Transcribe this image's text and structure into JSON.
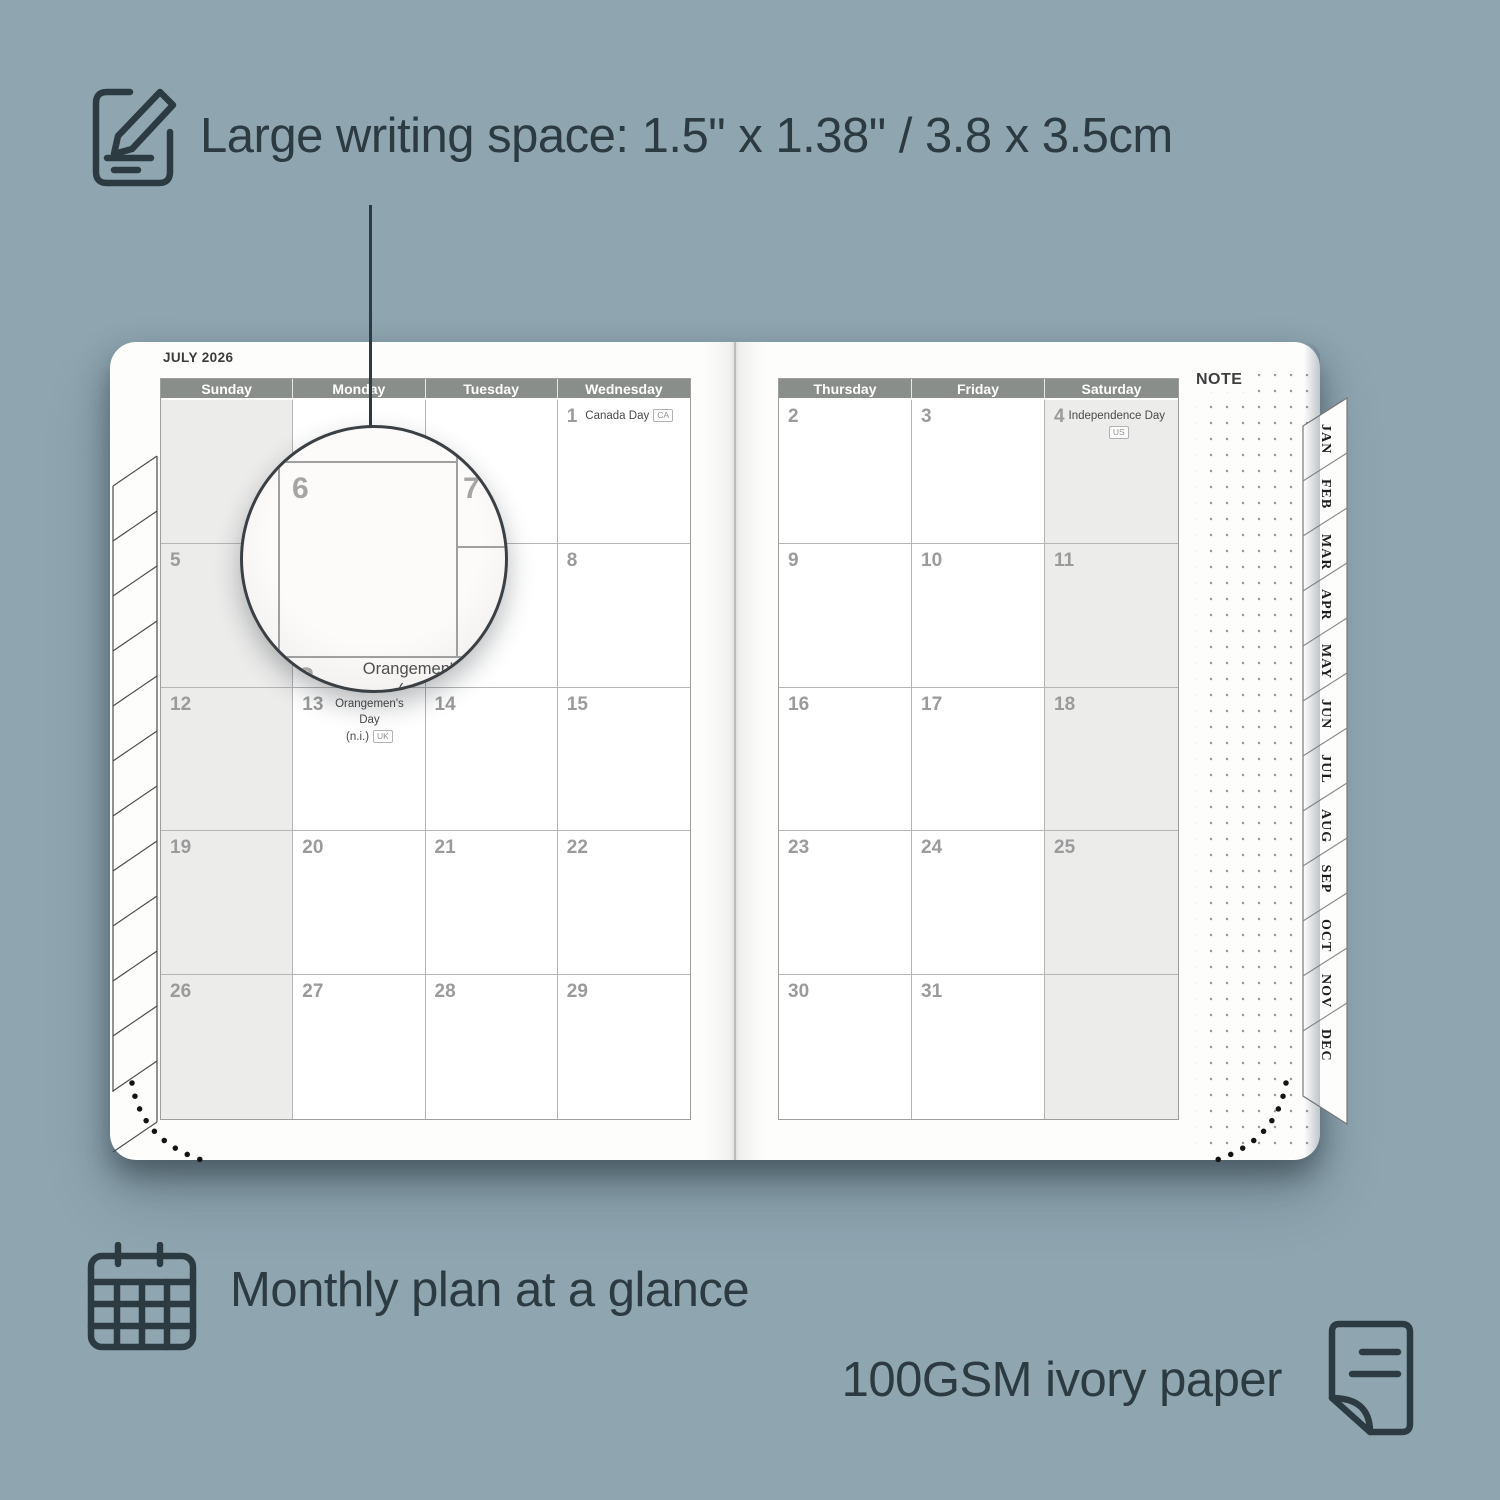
{
  "colors": {
    "background": "#8fa6b1",
    "ink": "#2c3a42",
    "page": "#fdfdfc",
    "day_header_bar": "#8a8e8a",
    "shaded_cell": "#ececeb",
    "date_number": "#9b9b9b"
  },
  "callouts": {
    "writing_space": "Large writing space: 1.5\" x 1.38\" / 3.8 x 3.5cm",
    "monthly_plan": "Monthly plan at a glance",
    "paper": "100GSM ivory paper"
  },
  "planner": {
    "month_title": "JULY 2026",
    "note_label": "NOTE",
    "month_tabs": [
      "JAN",
      "FEB",
      "MAR",
      "APR",
      "MAY",
      "JUN",
      "JUL",
      "AUG",
      "SEP",
      "OCT",
      "NOV",
      "DEC"
    ],
    "left_page": {
      "day_headers": [
        "Sunday",
        "Monday",
        "Tuesday",
        "Wednesday"
      ],
      "shaded_column": "Sunday",
      "rows": [
        [
          {
            "date": ""
          },
          {
            "date": ""
          },
          {
            "date": ""
          },
          {
            "date": "1",
            "holiday_line1": "Canada Day",
            "badge": "CA"
          }
        ],
        [
          {
            "date": "5"
          },
          {
            "date": "6"
          },
          {
            "date": "7"
          },
          {
            "date": "8"
          }
        ],
        [
          {
            "date": "12"
          },
          {
            "date": "13",
            "holiday_line1": "Orangemen's Day",
            "holiday_line2": "(n.i.)",
            "badge": "UK"
          },
          {
            "date": "14"
          },
          {
            "date": "15"
          }
        ],
        [
          {
            "date": "19"
          },
          {
            "date": "20"
          },
          {
            "date": "21"
          },
          {
            "date": "22"
          }
        ],
        [
          {
            "date": "26"
          },
          {
            "date": "27"
          },
          {
            "date": "28"
          },
          {
            "date": "29"
          }
        ]
      ]
    },
    "right_page": {
      "day_headers": [
        "Thursday",
        "Friday",
        "Saturday"
      ],
      "shaded_column": "Saturday",
      "rows": [
        [
          {
            "date": "2"
          },
          {
            "date": "3"
          },
          {
            "date": "4",
            "holiday_line1": "Independence Day",
            "badge": "US"
          }
        ],
        [
          {
            "date": "9"
          },
          {
            "date": "10"
          },
          {
            "date": "11"
          }
        ],
        [
          {
            "date": "16"
          },
          {
            "date": "17"
          },
          {
            "date": "18"
          }
        ],
        [
          {
            "date": "23"
          },
          {
            "date": "24"
          },
          {
            "date": "25"
          }
        ],
        [
          {
            "date": "30"
          },
          {
            "date": "31"
          },
          {
            "date": ""
          }
        ]
      ]
    }
  },
  "magnifier": {
    "dates": {
      "top_left": "6",
      "top_right": "7",
      "bottom": "13"
    },
    "holiday_line1": "Orangemen's Day",
    "holiday_line2": "(n.i.)",
    "badge": "UK"
  }
}
